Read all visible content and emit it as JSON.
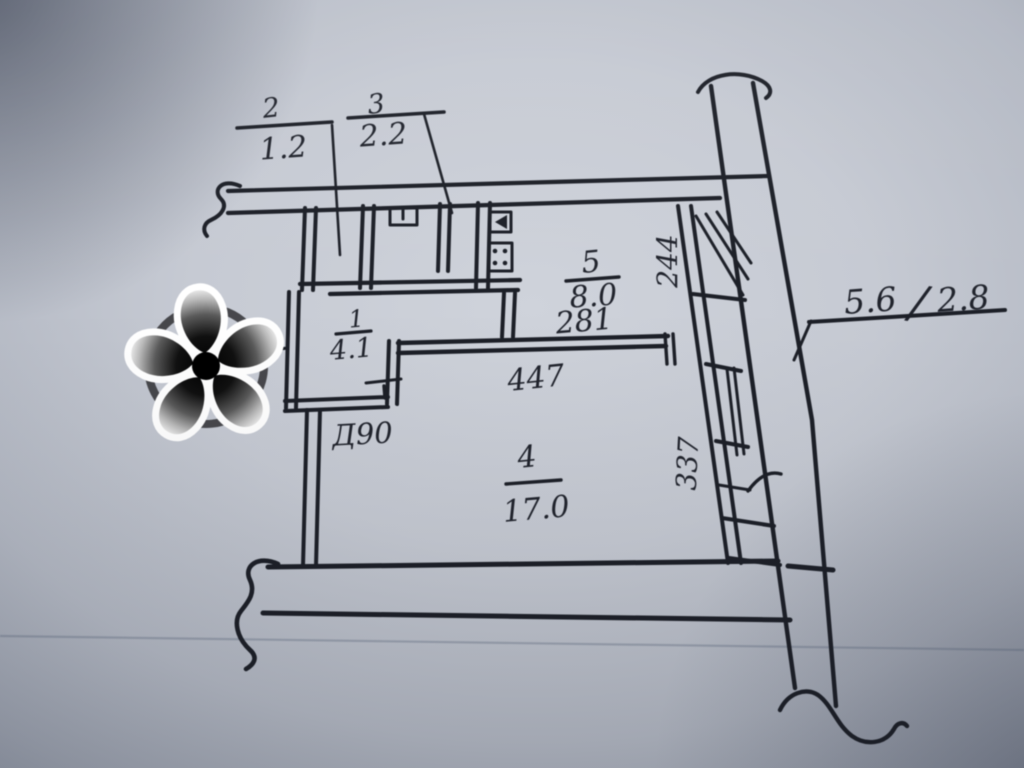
{
  "plan": {
    "room_labels": [
      {
        "id": "room-2",
        "number": "2",
        "area": "1.2"
      },
      {
        "id": "room-3",
        "number": "3",
        "area": "2.2"
      },
      {
        "id": "room-1",
        "number": "1",
        "area": "4.1"
      },
      {
        "id": "room-5",
        "number": "5",
        "area": "8.0"
      },
      {
        "id": "room-4",
        "number": "4",
        "area": "17.0"
      }
    ],
    "dimensions": {
      "kitchen_width": "281",
      "living_width": "447",
      "shaft_upper": "244",
      "shaft_lower": "337",
      "door": "Д90",
      "header_left": "5.6",
      "header_sep": "/",
      "header_right": "2.8"
    }
  },
  "watermark": {
    "name": "flower-asterisk"
  },
  "colors": {
    "ink": "#1c1f27",
    "paper_light": "#cfd3db",
    "paper_dark": "#878e9c",
    "watermark_outline": "#ffffff",
    "watermark_center": "#000000"
  }
}
